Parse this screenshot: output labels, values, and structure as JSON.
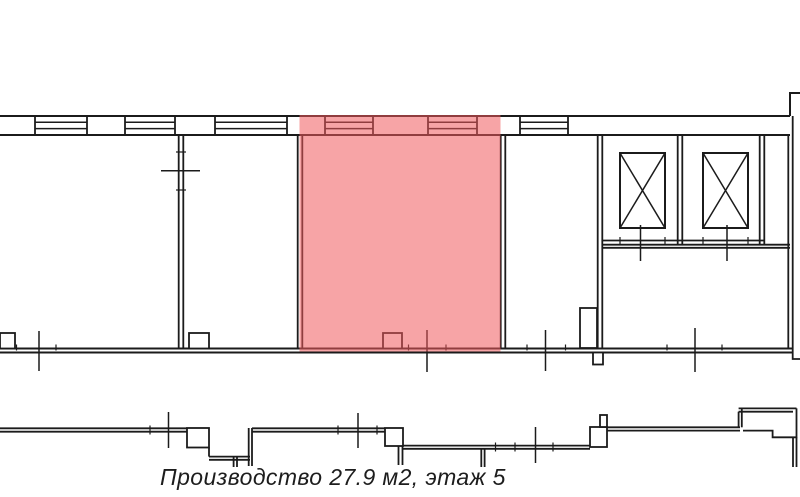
{
  "page": {
    "background": "#ffffff"
  },
  "colors": {
    "line": "#1b1b1b",
    "highlight_fill": "#f0595c",
    "highlight_opacity": "0.55",
    "text": "#1d1d1d"
  },
  "caption": {
    "full_text": "Производство 27.9 м2, этаж 5",
    "room_type": "Производство",
    "area": "27.9 м2",
    "floor": "этаж 5"
  },
  "highlighted_room": {
    "label": "Производство",
    "area_m2": 27.9,
    "floor_number": 5
  }
}
